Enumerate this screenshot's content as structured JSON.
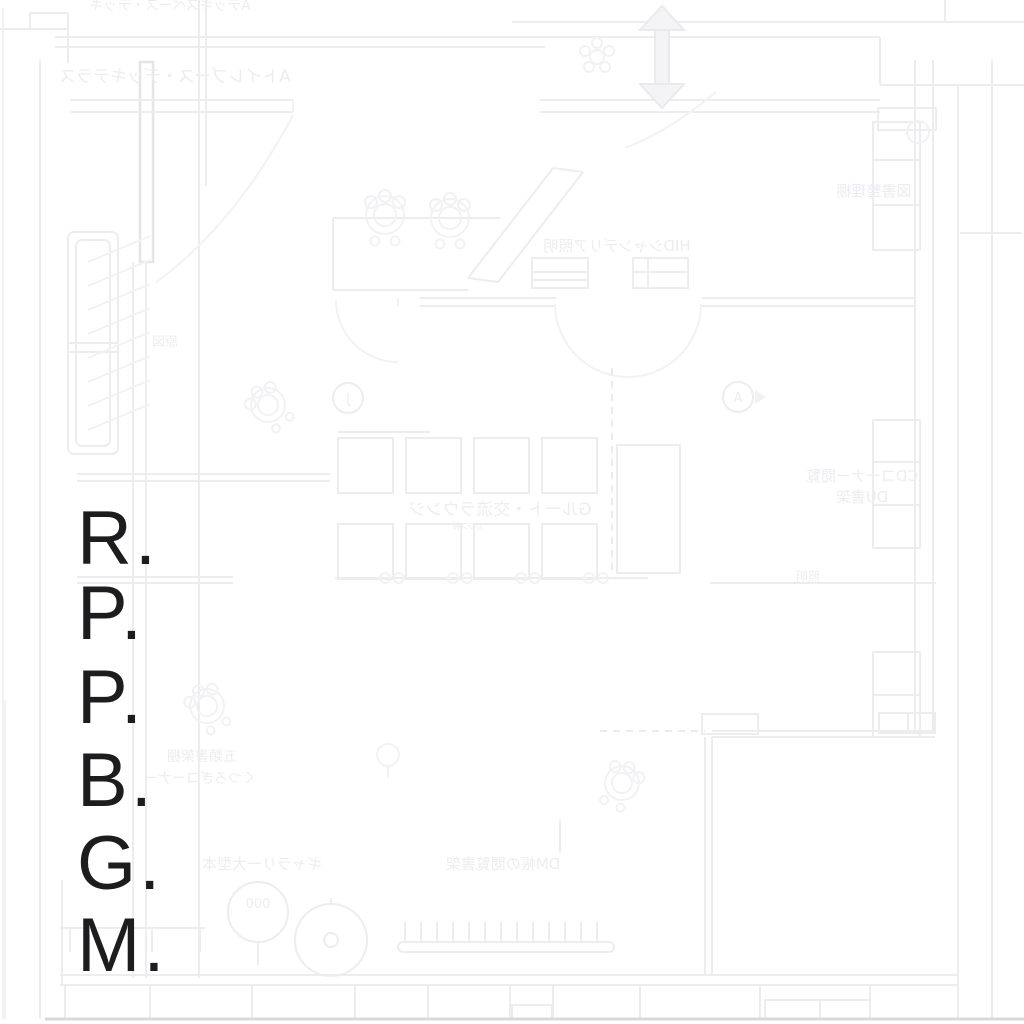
{
  "title": {
    "full": "R.P.P.B.G.M.",
    "letters": [
      "R.",
      "P.",
      "P.",
      "B.",
      "G.",
      "M."
    ],
    "color": "#1d1d20"
  },
  "plan": {
    "style": "faint architectural floor plan, mirrored (flipped) blueprint",
    "background_color": "#ffffff",
    "line_color": "#ededf0",
    "accent_line_color": "#e4e4e9",
    "label_color": "#ecedf1",
    "icons": [
      "double-arrow-icon",
      "chair-rosette-icon",
      "plant-icon",
      "round-table-icon"
    ],
    "markers": {
      "circle_left": "J",
      "circle_right": "A",
      "stool": "000"
    },
    "labels": [
      {
        "id": "top-edge",
        "text": "Aデッキスペース・デッキ",
        "mirrored": true
      },
      {
        "id": "upper-left",
        "text": "Aトイレブース・デッキテラス",
        "mirrored": true
      },
      {
        "id": "counter-area",
        "text": "HIDシャンデリア照明",
        "mirrored": true
      },
      {
        "id": "right-shelf",
        "text": "図書整理棚",
        "mirrored": true
      },
      {
        "id": "left-rack",
        "text": "原図",
        "mirrored": true
      },
      {
        "id": "center-lounge",
        "text": "Gルート・交流ラウンジ",
        "mirrored": true
      },
      {
        "id": "center-small",
        "text": "ガラス棚",
        "mirrored": true
      },
      {
        "id": "right-col-1",
        "text": "CDコーナー閲覧",
        "mirrored": true
      },
      {
        "id": "right-col-2",
        "text": "DU書架",
        "mirrored": true
      },
      {
        "id": "right-small",
        "text": "照明",
        "mirrored": true
      },
      {
        "id": "lower-left-1",
        "text": "五類書架棚",
        "mirrored": true
      },
      {
        "id": "lower-left-2",
        "text": "くつろぎコーナー",
        "mirrored": true
      },
      {
        "id": "bottom-row-1",
        "text": "ギャラリー大型本",
        "mirrored": true
      },
      {
        "id": "bottom-row-2",
        "text": "DM帳の閲覧書架",
        "mirrored": true
      },
      {
        "id": "stool-number",
        "text": "000",
        "mirrored": true
      },
      {
        "id": "marker-j",
        "text": "J",
        "mirrored": true
      },
      {
        "id": "marker-a",
        "text": "A",
        "mirrored": true
      }
    ]
  }
}
